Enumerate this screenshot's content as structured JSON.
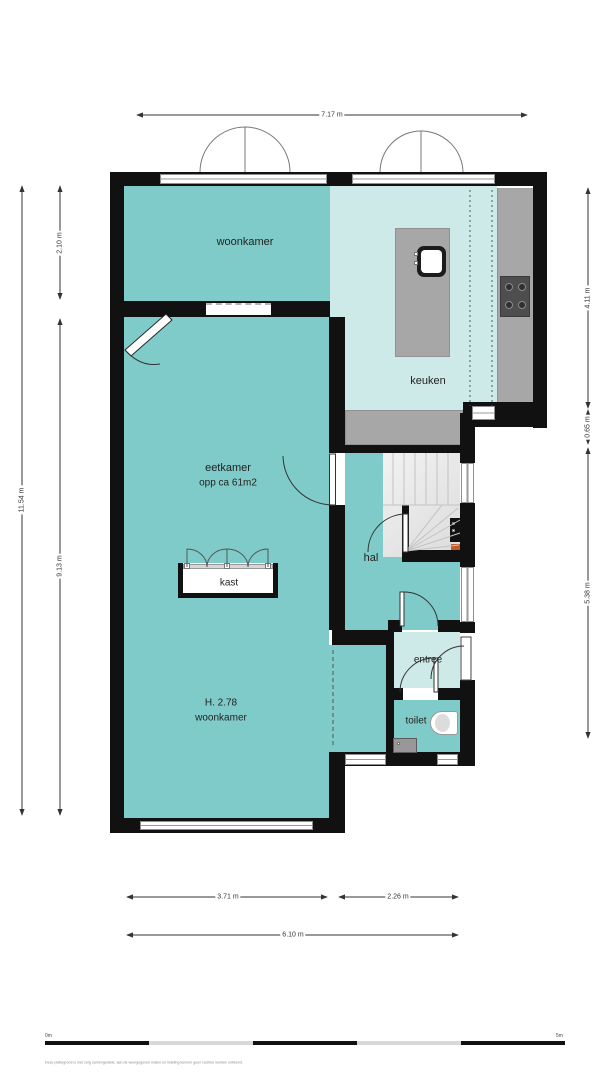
{
  "plan": {
    "type": "floor-plan",
    "rooms": {
      "woonkamer_top": {
        "label": "woonkamer"
      },
      "keuken": {
        "label": "keuken"
      },
      "eetkamer": {
        "label": "eetkamer",
        "area": "opp ca 61m2"
      },
      "hal": {
        "label": "hal"
      },
      "kast": {
        "label": "kast"
      },
      "entree": {
        "label": "entree"
      },
      "woonkamer_main": {
        "label": "woonkamer",
        "height": "H. 2.78"
      },
      "toilet": {
        "label": "toilet"
      }
    },
    "dimensions": {
      "top": "7.17 m",
      "left_outer": "11.54 m",
      "left_top": "2.10 m",
      "left_bottom": "9.13 m",
      "right_top": "4.11 m",
      "right_mid": "0.65 m",
      "right_bottom": "5.38 m",
      "bottom_left": "3.71 m",
      "bottom_right": "2.26 m",
      "bottom_total": "6.10 m"
    },
    "scale_bar": {
      "start": "0m",
      "end": "5m"
    },
    "disclaimer": "Deze plattegrond is met zorg samengesteld, aan de weergegeven maten en indeling kunnen geen rechten worden ontleend.",
    "colors": {
      "floor_teal": "#7fcbc9",
      "floor_light": "#cde9e8",
      "counter_gray": "#a7a7a7",
      "wall": "#111111"
    }
  }
}
